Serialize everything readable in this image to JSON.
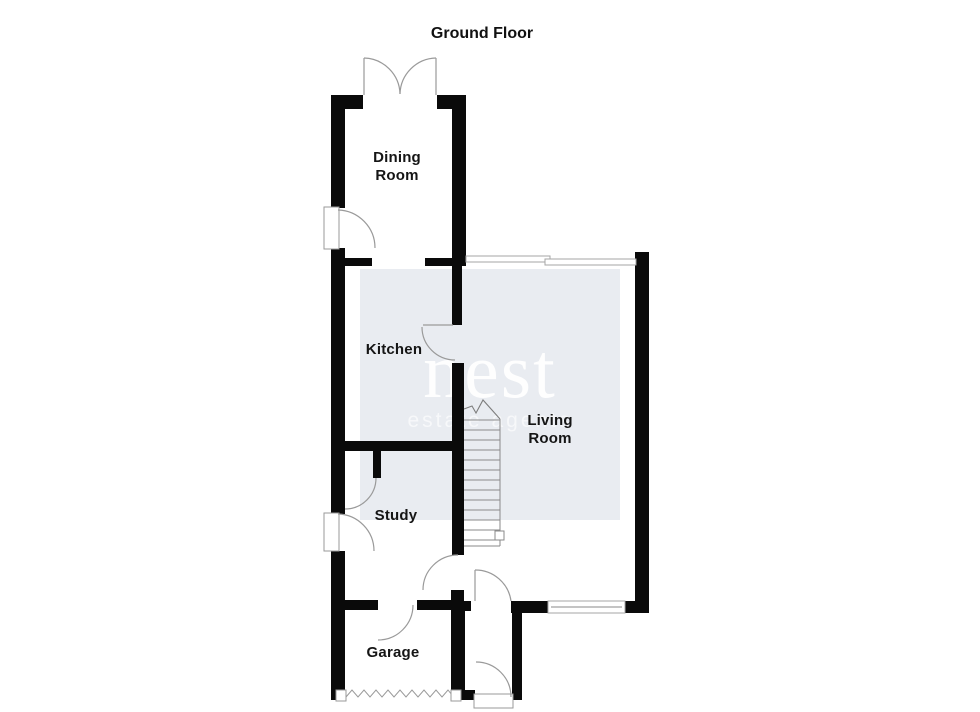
{
  "title": "Ground Floor",
  "rooms": {
    "dining": {
      "label": "Dining Room",
      "line1": "Dining",
      "line2": "Room"
    },
    "kitchen": {
      "label": "Kitchen"
    },
    "living": {
      "label": "Living Room",
      "line1": "Living",
      "line2": "Room"
    },
    "study": {
      "label": "Study"
    },
    "garage": {
      "label": "Garage"
    }
  },
  "watermark": {
    "brand": "nest",
    "tagline": "estate agents"
  },
  "colors": {
    "background": "#ffffff",
    "wall": "#0a0a0a",
    "door_arc": "#9a9a9a",
    "watermark_bg": "#e9ecf1",
    "watermark_text": "#ffffff",
    "label_text": "#151515"
  }
}
